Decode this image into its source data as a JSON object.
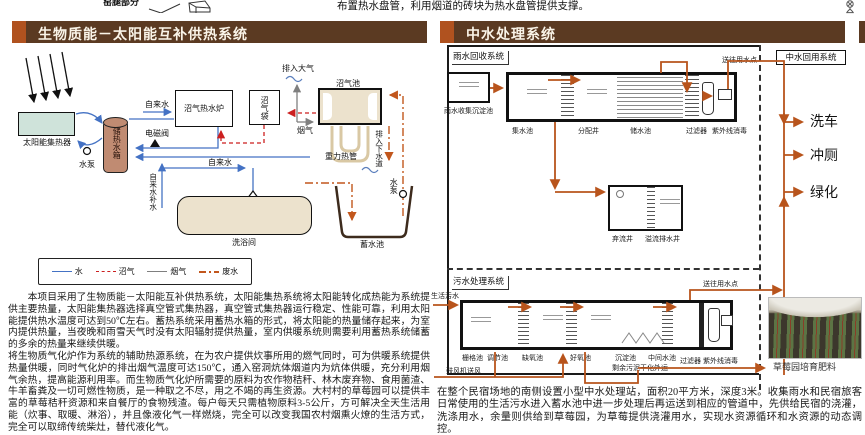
{
  "colors": {
    "bar-brown": "#5b3a22",
    "accent-rust": "#b0521f",
    "water-blue": "#4472c4",
    "biogas-red": "#cc1f1f",
    "flue-gray": "#7f7f7f",
    "waste-orange": "#c2571d",
    "flow-orange": "#b8541c",
    "tan-fill": "#ece2cd",
    "tank-brown": "#c08b72",
    "collector-green": "#cfe3da"
  },
  "top_strip": {
    "left_caption": "窑腿部分",
    "right_text": "布置热水盘管，利用烟道的砖块为热水盘管提供支撑。"
  },
  "left_panel": {
    "title": "生物质能－太阳能互补供热系统",
    "diagram": {
      "solar_collector": "太阳能集热器",
      "pump_left": "水泵",
      "storage_tank": "储热水箱",
      "solenoid_valve": "电磁阀",
      "tap_water_top": "自来水",
      "tap_water_mid": "自来水",
      "tap_water_makeup": "自来水补水",
      "biogas_boiler": "沼气热水炉",
      "biogas_bag": "沼气袋",
      "exhaust_atmosphere": "排入大气",
      "biogas_digester": "沼气池",
      "flue_gas": "烟气",
      "gravity_heat_pipe": "重力热管",
      "drain_sewer": "排入下水道",
      "pump_right": "水泵",
      "shower_room": "洗浴间",
      "storage_pool": "蓄水池",
      "legend": [
        {
          "label": "水"
        },
        {
          "label": "沼气"
        },
        {
          "label": "烟气"
        },
        {
          "label": "废水"
        }
      ]
    },
    "paragraphs": [
      "本项目采用了生物质能－太阳能互补供热系统，太阳能集热系统将太阳能转化成热能为系统提供主要热量，太阳能集热器选择真空管式集热器，真空管式集热器运行稳定、性能可靠，利用太阳能提供热水温度可达到50℃左右。蓄热系统采用蓄热水箱的形式，将太阳能的热量储存起来，为室内提供热量，当夜晚和雨雪天气时没有太阳辐射提供热量，室内供暖系统则需要利用蓄热系统储蓄的多余的热量来继续供暖。",
      "将生物质气化炉作为系统的辅助热源系统，在为农户提供炊事所用的燃气同时，可为供暖系统提供热量供暖，同时气化炉的排出烟气温度可达150℃，通入窑洞炕体烟道内为炕体供暖，充分利用烟气余热，提高能源利用率。而生物质气化炉所需要的原料为农作物秸秆、林木废弃物、食用菌渣、牛羊畜粪及一切可燃性物质，是一种取之不尽，用之不竭的再生资源。大村村的草莓园可以提供丰富的草莓秸秆资源和来自餐厅的食物残渣。每户每天只需植物原料3-5公斤，方可解决全天生活用能（炊事、取暖、淋浴），并且像液化气一样燃烧，完全可以改变我国农村烟熏火燎的生活方式，完全可以取缔传统柴灶，替代液化气。"
    ]
  },
  "right_panel": {
    "title": "中水处理系统",
    "rain_system": {
      "label": "雨水回收系统",
      "to_use_point": "送往用水点",
      "sedimentation": "雨水收集沉淀池",
      "stages": [
        "集水池",
        "分配井",
        "储水池",
        "过滤器",
        "紫外线消毒"
      ],
      "discard_well": "弃流井",
      "overflow_well": "溢流排水井"
    },
    "reuse_system": {
      "label": "中水回用系统",
      "outputs": [
        "洗车",
        "冲厕",
        "绿化"
      ]
    },
    "sewage_system": {
      "label": "污水处理系统",
      "inflow": "生活污水",
      "to_use_point": "送往用水点",
      "stages": [
        "栅格池",
        "调节池",
        "缺氧池",
        "好氧池",
        "沉淀池",
        "中间水池",
        "过滤器",
        "紫外线消毒"
      ],
      "blower": "鼓风机送风",
      "sludge": "剩余污泥干化外运"
    },
    "photo_caption": "草莓园培育肥料",
    "paragraph": "在整个民宿场地的南侧设置小型中水处理站，面积20平方米，深度3米。收集雨水和民宿旅客日常使用的生活污水进入蓄水池中进一步处理后再运送到相应的管道中，先供给民宿的浇灌，洗涤用水，余量则供给到草莓园，为草莓提供浇灌用水，实现水资源循环和水资源的动态调控。"
  }
}
